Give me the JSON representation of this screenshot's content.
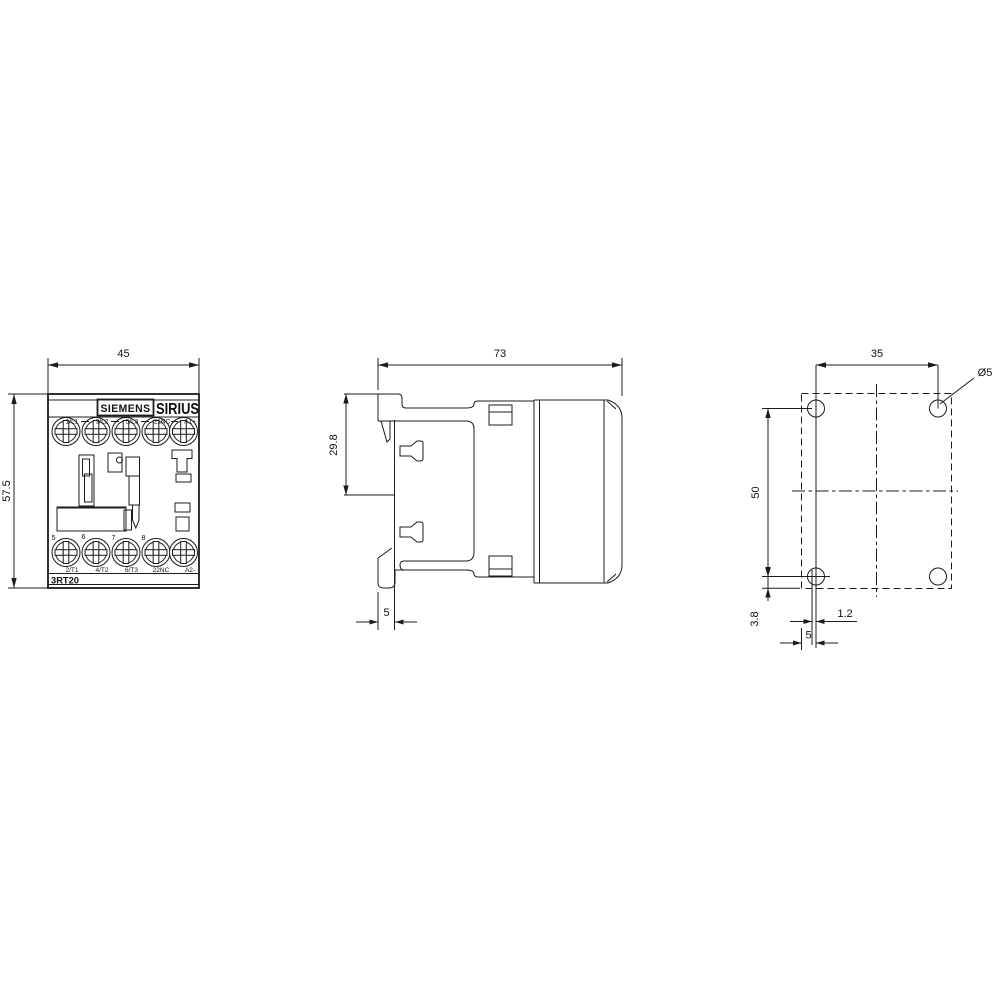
{
  "front_view": {
    "brand": "SIEMENS",
    "series": "SIRIUS",
    "model": "3RT20",
    "dim_width": "45",
    "dim_height": "57.5",
    "terminals_top": [
      "1/L1",
      "3/L2",
      "5/L3",
      "21NC",
      "A1+"
    ],
    "terminals_bottom": [
      "2/T1",
      "4/T2",
      "6/T3",
      "22NC",
      "A2-"
    ],
    "contact_numbers": [
      "5",
      "6",
      "7",
      "8"
    ]
  },
  "side_view": {
    "dim_depth": "73",
    "dim_din_rail": "29.8",
    "dim_claw_depth": "5"
  },
  "drill_view": {
    "dim_hole_spacing_h": "35",
    "dim_hole_spacing_v": "50",
    "hole_diameter": "Ø5",
    "dim_bottom_offset": "3.8",
    "dim_slot_offset": "1.2",
    "dim_side_offset": "5"
  }
}
